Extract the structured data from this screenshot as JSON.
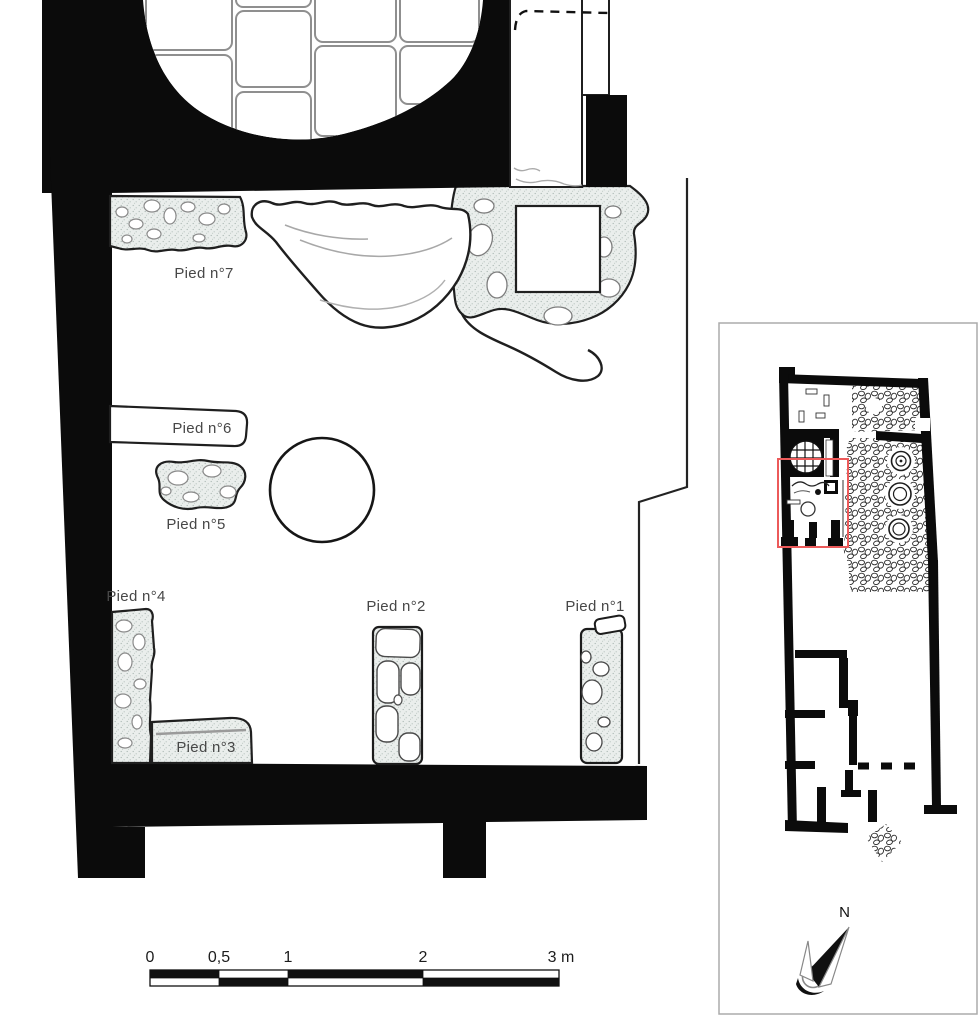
{
  "figure": {
    "type": "archaeological-excavation-plan",
    "background": "#ffffff"
  },
  "piers": {
    "p1": {
      "label": "Pied n°1"
    },
    "p2": {
      "label": "Pied n°2"
    },
    "p3": {
      "label": "Pied n°3"
    },
    "p4": {
      "label": "Pied n°4"
    },
    "p5": {
      "label": "Pied n°5"
    },
    "p6": {
      "label": "Pied n°6"
    },
    "p7": {
      "label": "Pied n°7"
    }
  },
  "scale_bar": {
    "ticks": [
      "0",
      "0,5",
      "1",
      "2",
      "3 m"
    ],
    "dark": "#111111",
    "light": "#ffffff"
  },
  "inset": {
    "north_label": "N",
    "highlight_color": "#ec5a5a",
    "border_color": "#ababab"
  },
  "colors": {
    "wall": "#0b0b0b",
    "outline": "#1f1f1f",
    "stipple_bg": "#eaeeec",
    "stipple_dot": "#aab7b2",
    "slab_stroke": "#8f8f8f",
    "label_text": "#474747"
  }
}
